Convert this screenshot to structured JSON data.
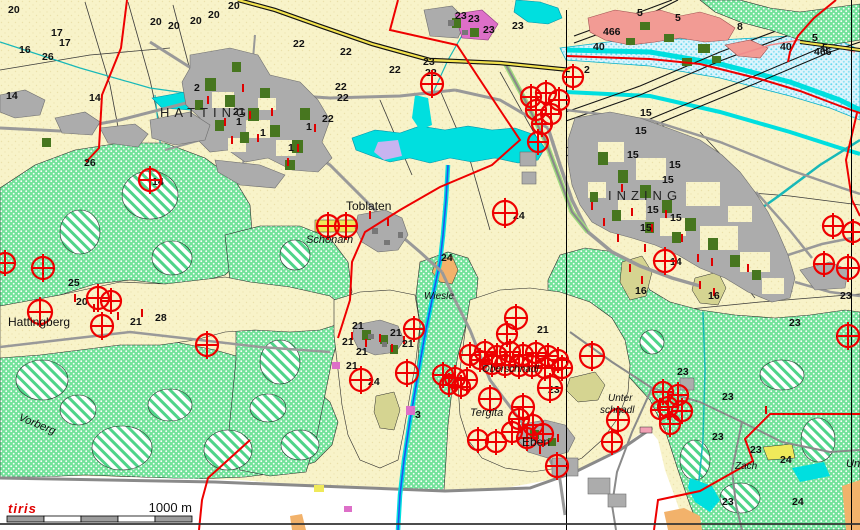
{
  "map": {
    "attribution": "tiris",
    "scale_bar": {
      "label": "1000 m"
    },
    "colors": {
      "cream": "#F8F3C9",
      "forest_green": "#72E29A",
      "dark_green": "#47761F",
      "settlement_gray": "#ACACAC",
      "road_gray": "#999999",
      "water_cyan": "#00DFDF",
      "floodplain_blue": "#DDF4FC",
      "boundary_red": "#EE0000",
      "marker_red": "#EE0000",
      "magenta": "#DD6FC8",
      "salmon": "#F29B94",
      "lavender": "#C8B4F0",
      "khaki": "#D5D491",
      "orange": "#F2B26B",
      "yellow": "#EFE95A"
    },
    "place_labels": [
      {
        "t": "HATTING",
        "x": 160,
        "y": 117,
        "cls": "caps"
      },
      {
        "t": "INZING",
        "x": 608,
        "y": 200,
        "cls": "caps"
      },
      {
        "t": "Toblaten",
        "x": 346,
        "y": 210,
        "cls": "plain"
      },
      {
        "t": "Schönarn",
        "x": 306,
        "y": 243,
        "cls": "ital"
      },
      {
        "t": "Hattingberg",
        "x": 8,
        "y": 326,
        "cls": "plain"
      },
      {
        "t": "Wiesle",
        "x": 424,
        "y": 299,
        "cls": "ital-sm"
      },
      {
        "t": "Tergita",
        "x": 470,
        "y": 416,
        "cls": "ital"
      },
      {
        "t": "Eben",
        "x": 522,
        "y": 446,
        "cls": "plain"
      },
      {
        "t": "Oberschnadl",
        "x": 482,
        "y": 372,
        "cls": "ital-sm"
      },
      {
        "t": "Unter",
        "x": 608,
        "y": 401,
        "cls": "ital-sm"
      },
      {
        "t": "schnadl",
        "x": 600,
        "y": 413,
        "cls": "ital-sm"
      },
      {
        "t": "Vorberg",
        "x": 18,
        "y": 420,
        "cls": "ital",
        "rot": 22
      },
      {
        "t": "Zach",
        "x": 735,
        "y": 469,
        "cls": "ital-sm"
      },
      {
        "t": "Un",
        "x": 846,
        "y": 467,
        "cls": "ital"
      }
    ],
    "parcel_numbers": [
      {
        "t": "20",
        "x": 150,
        "y": 25
      },
      {
        "t": "20",
        "x": 168,
        "y": 29
      },
      {
        "t": "20",
        "x": 190,
        "y": 24
      },
      {
        "t": "20",
        "x": 208,
        "y": 18
      },
      {
        "t": "20",
        "x": 228,
        "y": 9
      },
      {
        "t": "20",
        "x": 76,
        "y": 305
      },
      {
        "t": "20",
        "x": 8,
        "y": 13
      },
      {
        "t": "17",
        "x": 51,
        "y": 36
      },
      {
        "t": "17",
        "x": 59,
        "y": 46
      },
      {
        "t": "16",
        "x": 19,
        "y": 53
      },
      {
        "t": "16",
        "x": 635,
        "y": 294
      },
      {
        "t": "16",
        "x": 708,
        "y": 299
      },
      {
        "t": "26",
        "x": 42,
        "y": 60
      },
      {
        "t": "26",
        "x": 84,
        "y": 166
      },
      {
        "t": "14",
        "x": 6,
        "y": 99
      },
      {
        "t": "14",
        "x": 89,
        "y": 101
      },
      {
        "t": "14",
        "x": 152,
        "y": 185
      },
      {
        "t": "14",
        "x": 670,
        "y": 265
      },
      {
        "t": "2",
        "x": 194,
        "y": 91
      },
      {
        "t": "2",
        "x": 584,
        "y": 73
      },
      {
        "t": "1",
        "x": 236,
        "y": 125
      },
      {
        "t": "1",
        "x": 260,
        "y": 136
      },
      {
        "t": "1",
        "x": 288,
        "y": 151
      },
      {
        "t": "1",
        "x": 306,
        "y": 130
      },
      {
        "t": "21",
        "x": 233,
        "y": 115
      },
      {
        "t": "21",
        "x": 130,
        "y": 325
      },
      {
        "t": "21",
        "x": 352,
        "y": 329
      },
      {
        "t": "21",
        "x": 342,
        "y": 345
      },
      {
        "t": "21",
        "x": 356,
        "y": 355
      },
      {
        "t": "21",
        "x": 346,
        "y": 369
      },
      {
        "t": "21",
        "x": 390,
        "y": 336
      },
      {
        "t": "21",
        "x": 402,
        "y": 347
      },
      {
        "t": "21",
        "x": 537,
        "y": 333
      },
      {
        "t": "22",
        "x": 293,
        "y": 47
      },
      {
        "t": "22",
        "x": 340,
        "y": 55
      },
      {
        "t": "22",
        "x": 389,
        "y": 73
      },
      {
        "t": "22",
        "x": 335,
        "y": 90
      },
      {
        "t": "22",
        "x": 337,
        "y": 101
      },
      {
        "t": "22",
        "x": 322,
        "y": 122
      },
      {
        "t": "22",
        "x": 425,
        "y": 76
      },
      {
        "t": "23",
        "x": 455,
        "y": 19
      },
      {
        "t": "23",
        "x": 468,
        "y": 22
      },
      {
        "t": "23",
        "x": 483,
        "y": 33
      },
      {
        "t": "23",
        "x": 512,
        "y": 29
      },
      {
        "t": "23",
        "x": 423,
        "y": 65
      },
      {
        "t": "23",
        "x": 840,
        "y": 299
      },
      {
        "t": "23",
        "x": 789,
        "y": 326
      },
      {
        "t": "23",
        "x": 677,
        "y": 375
      },
      {
        "t": "23",
        "x": 722,
        "y": 400
      },
      {
        "t": "23",
        "x": 712,
        "y": 440
      },
      {
        "t": "23",
        "x": 750,
        "y": 453
      },
      {
        "t": "23",
        "x": 722,
        "y": 505
      },
      {
        "t": "23",
        "x": 548,
        "y": 393
      },
      {
        "t": "24",
        "x": 513,
        "y": 219
      },
      {
        "t": "24",
        "x": 368,
        "y": 385
      },
      {
        "t": "24",
        "x": 441,
        "y": 261
      },
      {
        "t": "24",
        "x": 780,
        "y": 463
      },
      {
        "t": "24",
        "x": 792,
        "y": 505
      },
      {
        "t": "25",
        "x": 68,
        "y": 286
      },
      {
        "t": "28",
        "x": 155,
        "y": 321
      },
      {
        "t": "15",
        "x": 640,
        "y": 116
      },
      {
        "t": "15",
        "x": 635,
        "y": 134
      },
      {
        "t": "15",
        "x": 627,
        "y": 158
      },
      {
        "t": "15",
        "x": 669,
        "y": 168
      },
      {
        "t": "15",
        "x": 662,
        "y": 183
      },
      {
        "t": "15",
        "x": 647,
        "y": 213
      },
      {
        "t": "15",
        "x": 670,
        "y": 221
      },
      {
        "t": "15",
        "x": 640,
        "y": 231
      },
      {
        "t": "40",
        "x": 593,
        "y": 50
      },
      {
        "t": "40",
        "x": 780,
        "y": 50
      },
      {
        "t": "466",
        "x": 603,
        "y": 35
      },
      {
        "t": "466",
        "x": 814,
        "y": 55
      },
      {
        "t": "5",
        "x": 637,
        "y": 16
      },
      {
        "t": "5",
        "x": 675,
        "y": 21
      },
      {
        "t": "5",
        "x": 812,
        "y": 41
      },
      {
        "t": "5",
        "x": 822,
        "y": 51
      },
      {
        "t": "8",
        "x": 737,
        "y": 30
      },
      {
        "t": "3",
        "x": 415,
        "y": 418
      }
    ],
    "markers": {
      "symbol": "circle-cross",
      "color": "#EE0000",
      "items": [
        {
          "x": 432,
          "y": 84,
          "r": 11
        },
        {
          "x": 573,
          "y": 77,
          "r": 10
        },
        {
          "x": 531,
          "y": 97,
          "r": 10
        },
        {
          "x": 546,
          "y": 93,
          "r": 10
        },
        {
          "x": 559,
          "y": 100,
          "r": 10
        },
        {
          "x": 536,
          "y": 110,
          "r": 10
        },
        {
          "x": 551,
          "y": 114,
          "r": 10
        },
        {
          "x": 542,
          "y": 124,
          "r": 10
        },
        {
          "x": 538,
          "y": 142,
          "r": 10
        },
        {
          "x": 505,
          "y": 213,
          "r": 12
        },
        {
          "x": 833,
          "y": 226,
          "r": 10
        },
        {
          "x": 853,
          "y": 232,
          "r": 10
        },
        {
          "x": 824,
          "y": 264,
          "r": 10
        },
        {
          "x": 848,
          "y": 268,
          "r": 11
        },
        {
          "x": 665,
          "y": 261,
          "r": 11
        },
        {
          "x": 848,
          "y": 336,
          "r": 11
        },
        {
          "x": 5,
          "y": 263,
          "r": 10
        },
        {
          "x": 43,
          "y": 268,
          "r": 11
        },
        {
          "x": 40,
          "y": 312,
          "r": 12
        },
        {
          "x": 98,
          "y": 298,
          "r": 11
        },
        {
          "x": 111,
          "y": 301,
          "r": 10
        },
        {
          "x": 102,
          "y": 326,
          "r": 11
        },
        {
          "x": 150,
          "y": 180,
          "r": 11
        },
        {
          "x": 207,
          "y": 345,
          "r": 11
        },
        {
          "x": 328,
          "y": 226,
          "r": 11
        },
        {
          "x": 346,
          "y": 226,
          "r": 11
        },
        {
          "x": 414,
          "y": 329,
          "r": 10
        },
        {
          "x": 407,
          "y": 373,
          "r": 11
        },
        {
          "x": 361,
          "y": 380,
          "r": 11
        },
        {
          "x": 516,
          "y": 318,
          "r": 11
        },
        {
          "x": 507,
          "y": 334,
          "r": 10
        },
        {
          "x": 485,
          "y": 352,
          "r": 10
        },
        {
          "x": 497,
          "y": 356,
          "r": 10
        },
        {
          "x": 510,
          "y": 352,
          "r": 10
        },
        {
          "x": 523,
          "y": 355,
          "r": 10
        },
        {
          "x": 536,
          "y": 353,
          "r": 10
        },
        {
          "x": 548,
          "y": 356,
          "r": 10
        },
        {
          "x": 558,
          "y": 360,
          "r": 10
        },
        {
          "x": 470,
          "y": 355,
          "r": 10
        },
        {
          "x": 480,
          "y": 360,
          "r": 9
        },
        {
          "x": 492,
          "y": 364,
          "r": 10
        },
        {
          "x": 505,
          "y": 365,
          "r": 10
        },
        {
          "x": 519,
          "y": 366,
          "r": 10
        },
        {
          "x": 532,
          "y": 366,
          "r": 10
        },
        {
          "x": 545,
          "y": 368,
          "r": 10
        },
        {
          "x": 562,
          "y": 368,
          "r": 10
        },
        {
          "x": 443,
          "y": 375,
          "r": 10
        },
        {
          "x": 455,
          "y": 378,
          "r": 10
        },
        {
          "x": 467,
          "y": 380,
          "r": 10
        },
        {
          "x": 449,
          "y": 385,
          "r": 9
        },
        {
          "x": 461,
          "y": 387,
          "r": 9
        },
        {
          "x": 490,
          "y": 399,
          "r": 11
        },
        {
          "x": 523,
          "y": 407,
          "r": 11
        },
        {
          "x": 550,
          "y": 388,
          "r": 12
        },
        {
          "x": 592,
          "y": 356,
          "r": 12
        },
        {
          "x": 519,
          "y": 419,
          "r": 10
        },
        {
          "x": 533,
          "y": 425,
          "r": 10
        },
        {
          "x": 512,
          "y": 432,
          "r": 10
        },
        {
          "x": 527,
          "y": 438,
          "r": 10
        },
        {
          "x": 543,
          "y": 434,
          "r": 10
        },
        {
          "x": 478,
          "y": 440,
          "r": 10
        },
        {
          "x": 496,
          "y": 442,
          "r": 10
        },
        {
          "x": 557,
          "y": 466,
          "r": 11
        },
        {
          "x": 618,
          "y": 420,
          "r": 11
        },
        {
          "x": 612,
          "y": 442,
          "r": 10
        },
        {
          "x": 663,
          "y": 392,
          "r": 10
        },
        {
          "x": 678,
          "y": 395,
          "r": 10
        },
        {
          "x": 668,
          "y": 407,
          "r": 10
        },
        {
          "x": 682,
          "y": 411,
          "r": 10
        },
        {
          "x": 670,
          "y": 424,
          "r": 10
        },
        {
          "x": 660,
          "y": 410,
          "r": 9
        }
      ]
    },
    "red_ticks": [
      {
        "x": 208,
        "y": 100
      },
      {
        "x": 225,
        "y": 122
      },
      {
        "x": 243,
        "y": 88
      },
      {
        "x": 258,
        "y": 138
      },
      {
        "x": 272,
        "y": 112
      },
      {
        "x": 298,
        "y": 148
      },
      {
        "x": 315,
        "y": 128
      },
      {
        "x": 288,
        "y": 162
      },
      {
        "x": 232,
        "y": 140
      },
      {
        "x": 250,
        "y": 115
      },
      {
        "x": 604,
        "y": 222
      },
      {
        "x": 618,
        "y": 238
      },
      {
        "x": 632,
        "y": 212
      },
      {
        "x": 652,
        "y": 228
      },
      {
        "x": 666,
        "y": 214
      },
      {
        "x": 682,
        "y": 238
      },
      {
        "x": 698,
        "y": 258
      },
      {
        "x": 592,
        "y": 206
      },
      {
        "x": 622,
        "y": 188
      },
      {
        "x": 645,
        "y": 248
      },
      {
        "x": 712,
        "y": 262
      },
      {
        "x": 748,
        "y": 268
      },
      {
        "x": 352,
        "y": 336
      },
      {
        "x": 366,
        "y": 343
      },
      {
        "x": 380,
        "y": 338
      },
      {
        "x": 392,
        "y": 348
      },
      {
        "x": 404,
        "y": 340
      },
      {
        "x": 370,
        "y": 215
      },
      {
        "x": 388,
        "y": 222
      },
      {
        "x": 94,
        "y": 308
      },
      {
        "x": 118,
        "y": 316
      },
      {
        "x": 142,
        "y": 313
      },
      {
        "x": 75,
        "y": 298
      },
      {
        "x": 630,
        "y": 268
      },
      {
        "x": 642,
        "y": 280
      },
      {
        "x": 700,
        "y": 285
      },
      {
        "x": 714,
        "y": 292
      },
      {
        "x": 540,
        "y": 450
      },
      {
        "x": 558,
        "y": 438
      },
      {
        "x": 766,
        "y": 410
      }
    ]
  }
}
